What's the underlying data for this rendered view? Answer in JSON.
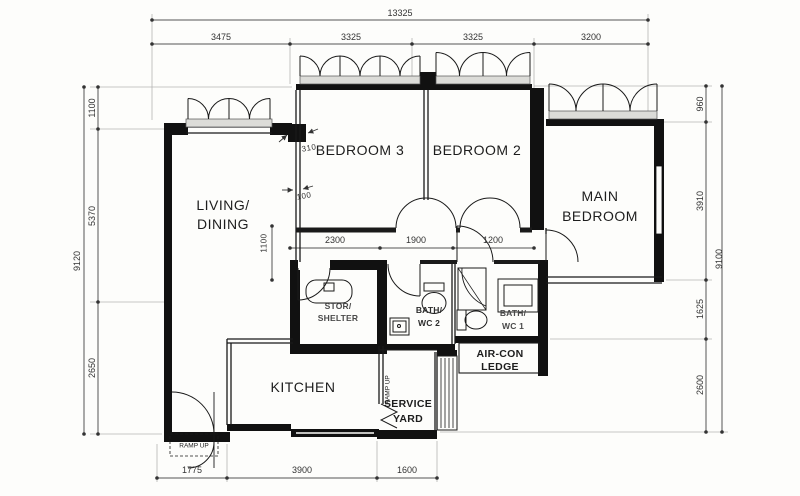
{
  "rooms": {
    "living": [
      "LIVING/",
      "DINING"
    ],
    "bedroom3": "BEDROOM 3",
    "bedroom2": "BEDROOM 2",
    "main": [
      "MAIN",
      "BEDROOM"
    ],
    "kitchen": "KITCHEN",
    "service": [
      "SERVICE",
      "YARD"
    ],
    "aircon": [
      "AIR-CON",
      "LEDGE"
    ],
    "store": [
      "STOR/",
      "SHELTER"
    ],
    "wc2": [
      "BATH/",
      "WC 2"
    ],
    "wc1": [
      "BATH/",
      "WC 1"
    ]
  },
  "dims": {
    "top_total": "13325",
    "top": [
      "3475",
      "3325",
      "3325",
      "3200"
    ],
    "left": [
      "1100",
      "5370",
      "2650"
    ],
    "left_total": "9120",
    "right": [
      "960",
      "3910",
      "1625",
      "2600"
    ],
    "right_total": "9100",
    "bottom": [
      "1775",
      "3900",
      "1600"
    ],
    "mid": [
      "2300",
      "1900",
      "1200"
    ],
    "mid_vertical": "1100",
    "wall_offsets": [
      "310",
      "100"
    ]
  },
  "annotations": {
    "ramp_entrance": "RAMP UP",
    "ramp_yard": "RAMP UP"
  },
  "colors": {
    "wall": "#111111",
    "line": "#1a1a1a",
    "dim_line": "#555555",
    "paper": "#fdfdfb"
  }
}
